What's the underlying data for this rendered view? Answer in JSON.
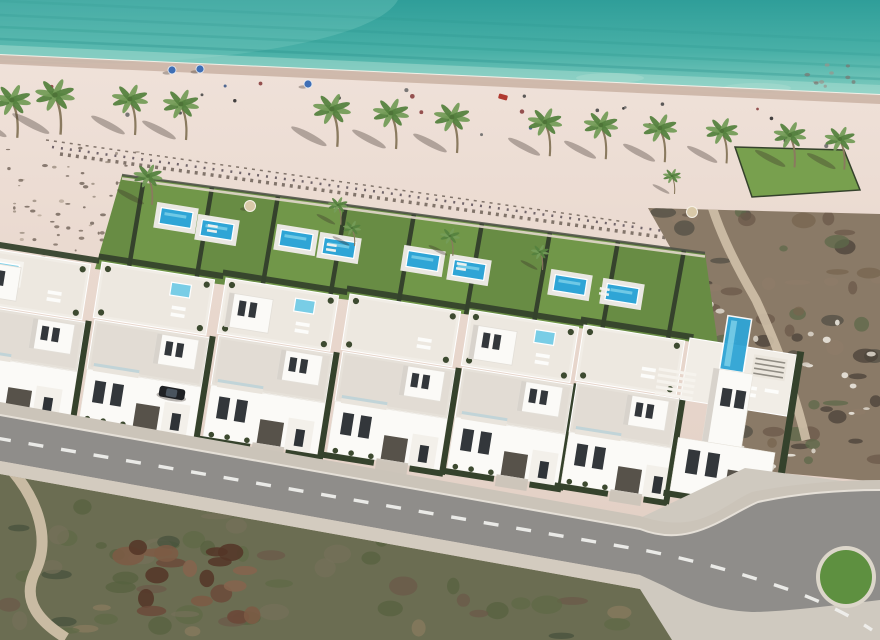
{
  "scene": {
    "description": "Aerial 3D render of a beachfront villa development: turquoise sea, sandy beach with palm trees, private garden plots with pools, white modern villas with roof terraces, curved asphalt road and scrubland foreground",
    "canvas": {
      "width": 880,
      "height": 640
    },
    "palette": {
      "sea_deep": "#2f9e99",
      "sea_mid": "#49b0a7",
      "sea_shallow": "#82cdc0",
      "sea_streak": "#1f8a84",
      "shallow_band": "#a9ded1",
      "foam": "#f6f2ea",
      "wet_sand": "#c9b2a3",
      "sand_top": "#f1e4dc",
      "sand_mid": "#e9d8ce",
      "sand_low": "#e0cdc2",
      "debris": "#6f6158",
      "debris2": "#5a4f57",
      "lawn": "#688c44",
      "lawn_alt": "#78a04e",
      "hedge": "#35422c",
      "fence_dark": "#4b4f45",
      "promenade": "#e3d8cb",
      "pool_water": "#2fa5d6",
      "pool_light": "#7fd2ea",
      "jacuzzi": "#79cde6",
      "pool_deck": "#eae8e3",
      "villa_white": "#fbfaf7",
      "villa_roof": "#f1ede6",
      "villa_roof2": "#e6e1d9",
      "villa_shade": "#d8d3cc",
      "window_dark": "#33373b",
      "garage": "#57524a",
      "balcony_glass": "#b9d2d8",
      "porch": "#f3f0ea",
      "road_asphalt": "#8f8d8a",
      "road_line": "#efefec",
      "sidewalk": "#cbc4b9",
      "kerb": "#e8e3da",
      "pavement": "#cfc9bf",
      "scrub_base": "#6b6d52",
      "dirt": "#cfc0a8",
      "ruin_brown": "#6b4a3a",
      "terrain_base": "#8a7a67",
      "rock_white": "#eae6dd",
      "palm_leaf": "#749c58",
      "palm_leaf_dark": "#55823f",
      "palm_trunk": "#8a7a5f",
      "palm_core": "#4e7438",
      "shadow": "rgba(58,48,40,0.34)",
      "car_body": "#1f2124",
      "car_glass": "#4a545e",
      "umbrella_blue": "#3f6fb5",
      "accent_red": "#b03a30",
      "roundabout_green": "#5e9040",
      "roundabout_rim": "#dcd6ca"
    },
    "sea": {
      "shore_left_y": 55,
      "shore_right_y": 95,
      "streaks": [
        {
          "off": 16,
          "o": 0.28
        },
        {
          "off": 28,
          "o": 0.2
        },
        {
          "off": 40,
          "o": 0.16
        },
        {
          "off": 54,
          "o": 0.12
        }
      ],
      "sandbars": [
        [
          610,
          78
        ],
        [
          757,
          88
        ]
      ]
    },
    "beach": {
      "umbrellas": [
        [
          172,
          70
        ],
        [
          200,
          69
        ],
        [
          308,
          84
        ]
      ],
      "red_item": [
        503,
        97
      ],
      "people": {
        "count": 26,
        "seed": 21
      },
      "pebbles": {
        "x": 805,
        "y": 64,
        "w": 70,
        "h": 28,
        "count": 10,
        "seed": 4
      },
      "debris_lines": [
        [
          60,
          154,
          755,
          250
        ],
        [
          52,
          147,
          700,
          236
        ],
        [
          46,
          140,
          640,
          224
        ]
      ],
      "dune_speckles": {
        "x": 0,
        "y": 146,
        "w": 138,
        "h": 118,
        "count": 60,
        "seed": 3
      },
      "dune_palm": [
        148,
        176,
        0.8
      ]
    },
    "palms": {
      "beach": [
        [
          12,
          100,
          1.05
        ],
        [
          55,
          95,
          1.1
        ],
        [
          130,
          99,
          1.0
        ],
        [
          181,
          104,
          1.0
        ],
        [
          332,
          109,
          1.05
        ],
        [
          391,
          113,
          1.0
        ],
        [
          452,
          117,
          1.0
        ],
        [
          545,
          122,
          0.95
        ],
        [
          601,
          125,
          0.95
        ],
        [
          660,
          128,
          0.95
        ],
        [
          722,
          131,
          0.9
        ],
        [
          790,
          135,
          0.9
        ],
        [
          840,
          139,
          0.85
        ]
      ],
      "garden": [
        [
          338,
          205,
          0.55
        ],
        [
          352,
          228,
          0.5
        ],
        [
          450,
          236,
          0.55
        ],
        [
          540,
          252,
          0.5
        ],
        [
          672,
          176,
          0.5
        ]
      ]
    },
    "gardens": {
      "band": "M122,175 L705,253 L718,345 L95,269 Z",
      "top_line": [
        122,
        175,
        705,
        253
      ],
      "bottom_line": [
        -30,
        254,
        718,
        345
      ],
      "hedge_xs": [
        128,
        196,
        262,
        330,
        398,
        466,
        534,
        602,
        668
      ],
      "pools": [
        [
          176,
          218
        ],
        [
          217,
          230
        ],
        [
          296,
          240
        ],
        [
          339,
          248
        ],
        [
          423,
          261
        ],
        [
          469,
          270
        ],
        [
          570,
          285
        ],
        [
          622,
          294
        ]
      ],
      "parasols": [
        [
          250,
          206
        ],
        [
          692,
          212
        ]
      ],
      "loungers": [
        [
          208,
          224
        ],
        [
          327,
          243
        ],
        [
          457,
          262
        ],
        [
          600,
          287
        ]
      ]
    },
    "terrain": {
      "poly": "M648,208 L880,214 L880,482 L748,470 L700,300 Z",
      "blobs": {
        "count": 80,
        "seed": 11
      },
      "rocks": {
        "count": 36,
        "seed": 5
      },
      "path": "M706,186 C716,226 734,262 756,300 C778,348 796,396 806,440",
      "lawn": "M735,147 L844,150 L860,190 L752,197 Z"
    },
    "villas": {
      "rotation": 9,
      "clusters": [
        {
          "x": -26,
          "y": 246,
          "w": 126,
          "tall": true,
          "roofpool": true,
          "jac": false
        },
        {
          "x": 102,
          "y": 262,
          "w": 122,
          "tall": false,
          "roofpool": false,
          "jac": true
        },
        {
          "x": 226,
          "y": 278,
          "w": 122,
          "tall": true,
          "roofpool": false,
          "jac": true
        },
        {
          "x": 350,
          "y": 294,
          "w": 120,
          "tall": false,
          "roofpool": false,
          "jac": false
        },
        {
          "x": 470,
          "y": 310,
          "w": 118,
          "tall": true,
          "roofpool": false,
          "jac": true
        },
        {
          "x": 584,
          "y": 325,
          "w": 110,
          "tall": false,
          "roofpool": false,
          "jac": false
        }
      ],
      "right_villa": {
        "x": 690,
        "y": 338
      }
    },
    "road": {
      "pavement_br": "M640,518 L745,468 L880,486 L880,640 L640,640 Z",
      "asphalt_main": "M0,415 L640,529 L640,575 L0,461 Z",
      "asphalt_bend": "M640,529 C690,549 725,516 758,502 C795,494 838,490 880,490 L880,600 C830,606 780,612 752,612 C712,610 688,599 664,586 L640,575 Z",
      "sidewalk_top": "M0,402 L640,516 L640,529 L0,415 Z",
      "sidewalk_curve": "M640,516 C700,536 722,505 752,492 C792,484 838,480 880,480 L880,490 C838,490 795,494 758,502 C725,516 690,549 640,529 Z",
      "lower_strip": "M0,461 L640,575 L640,589 L0,474 Z",
      "kerb_line": "M0,415 L640,529 C690,549 725,516 758,502 C795,494 838,490 880,490",
      "dash_path": "M-4,438 L648,551 C720,566 760,580 790,590 C820,601 848,614 872,630",
      "car": {
        "x": 172,
        "y": 393,
        "angle": 10
      },
      "roundabout": {
        "cx": 846,
        "cy": 577,
        "rx": 26,
        "ry": 27
      }
    },
    "foreground": {
      "poly": "M0,474 L640,589 L672,640 L0,640 Z",
      "blobs": {
        "count": 95,
        "seed": 7
      },
      "ruin": {
        "cx": 190,
        "cy": 585,
        "rx": 64,
        "ry": 40,
        "count": 20,
        "seed": 9
      },
      "path": "M10,468 C38,500 52,540 34,574 C22,602 40,622 66,638"
    }
  }
}
